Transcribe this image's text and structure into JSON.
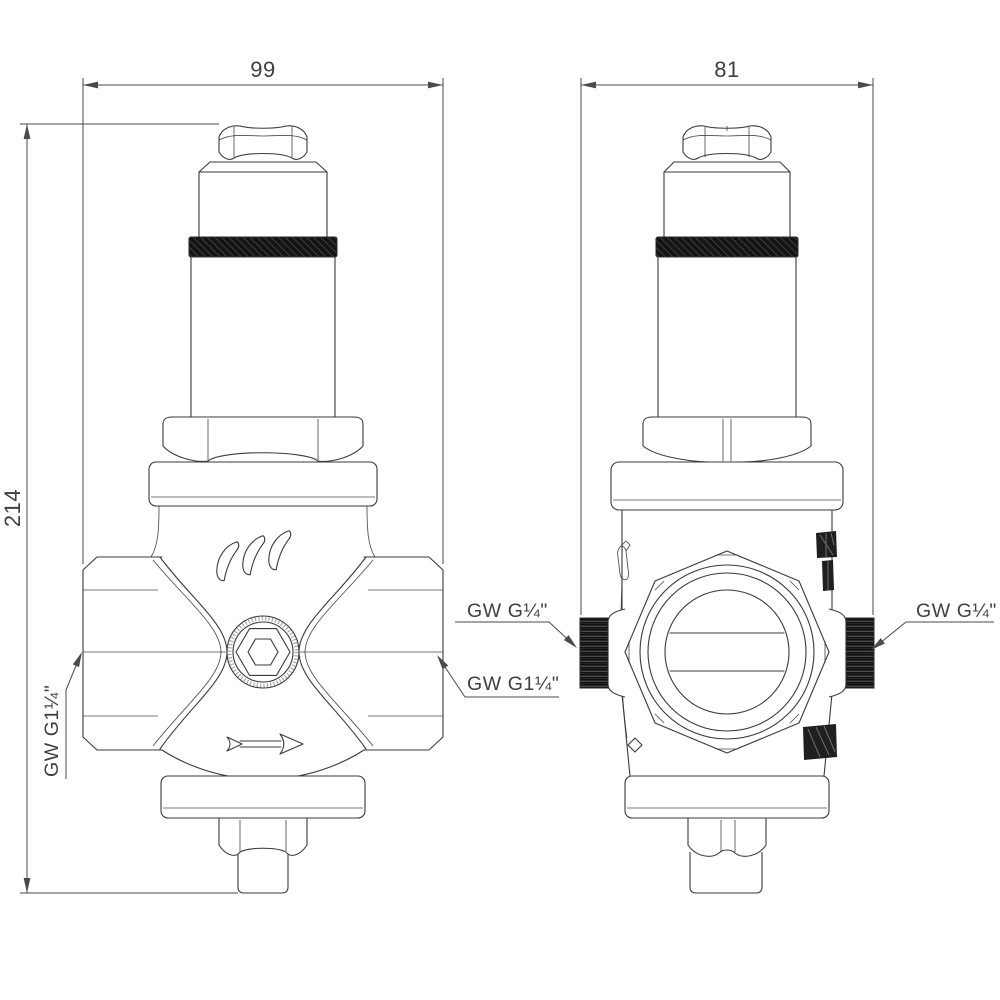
{
  "drawing": {
    "dimensions": {
      "front_width": "99",
      "side_width": "81",
      "height": "214"
    },
    "labels": {
      "front_inlet": "GW G1¼\"",
      "front_outlet": "GW G1¼\"",
      "side_port_left": "GW G¼\"",
      "side_port_right": "GW G¼\""
    },
    "colors": {
      "line": "#3a3a3a",
      "dim_line": "#4a4a4a",
      "knurl_fill": "#141414",
      "background": "#ffffff"
    }
  }
}
